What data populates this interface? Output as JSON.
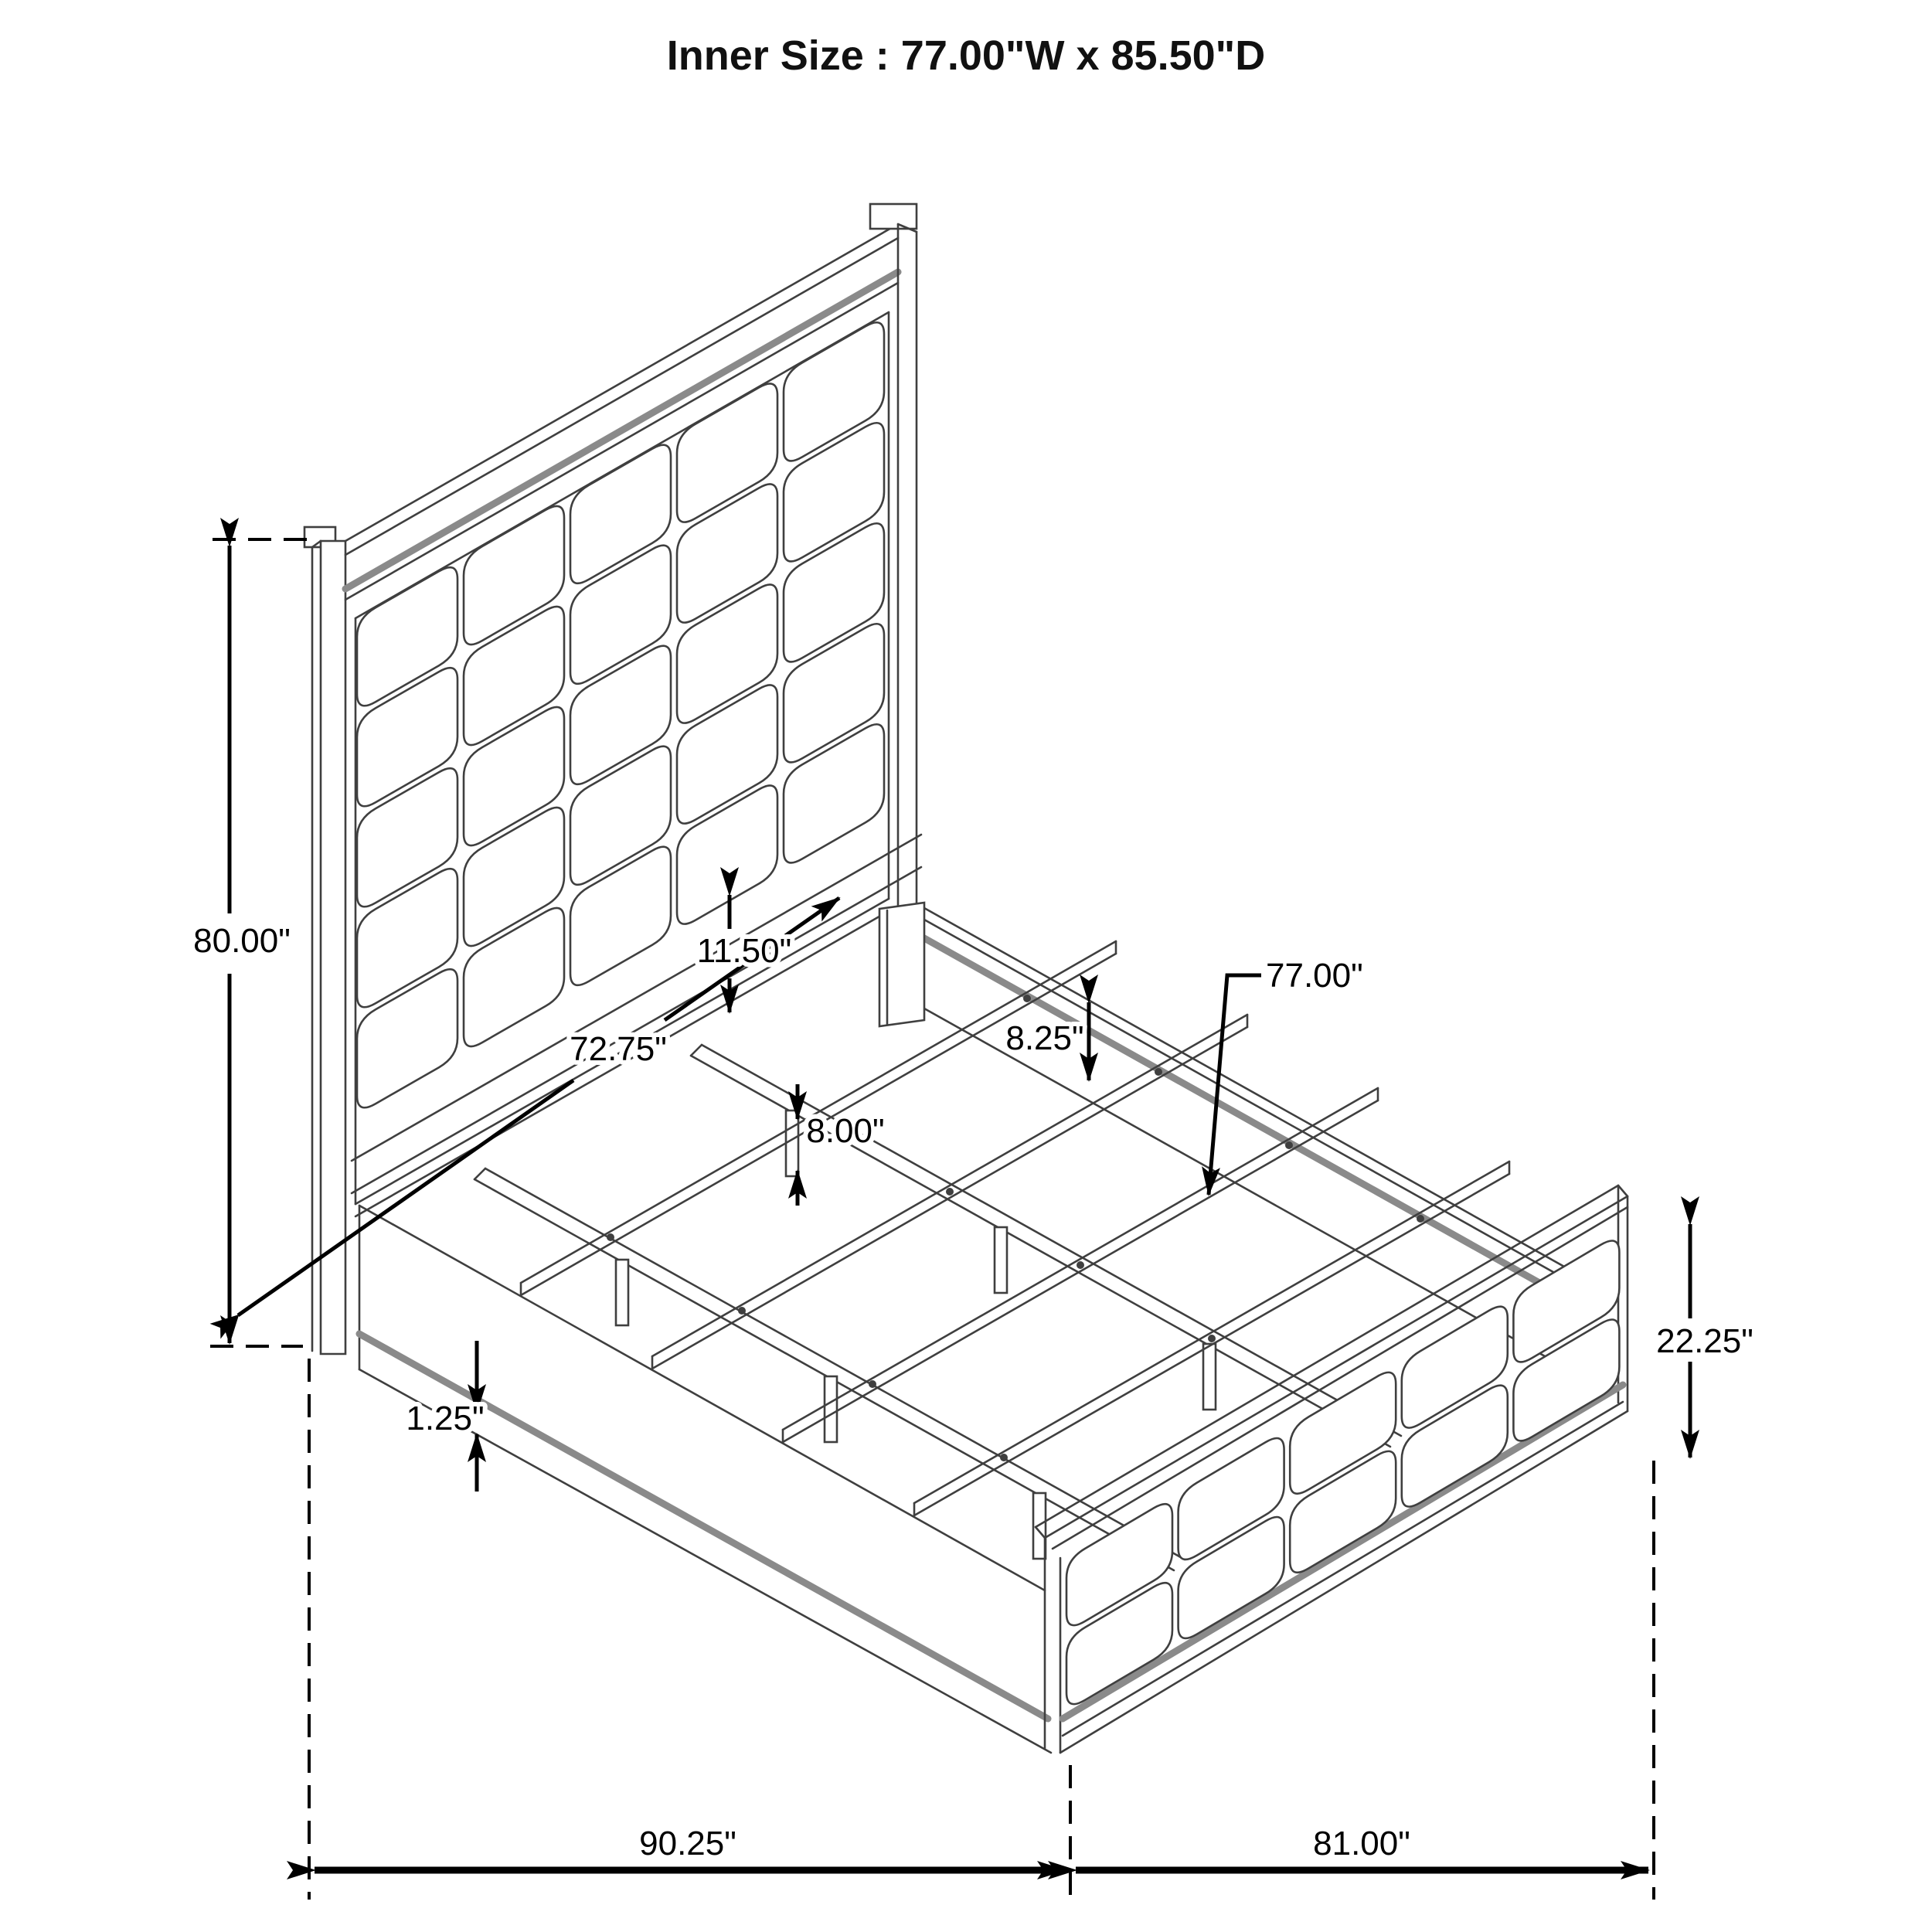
{
  "title": "Inner Size : 77.00\"W x 85.50\"D",
  "dimensions": {
    "headboard_height": "80.00\"",
    "inner_rail_length": "72.75\"",
    "headboard_panel_gap": "11.50\"",
    "support_leg_height": "8.00\"",
    "side_rail_height": "8.25\"",
    "slat_length": "77.00\"",
    "base_reveal": "1.25\"",
    "footboard_height": "22.25\"",
    "overall_length": "90.25\"",
    "overall_width": "81.00\""
  }
}
